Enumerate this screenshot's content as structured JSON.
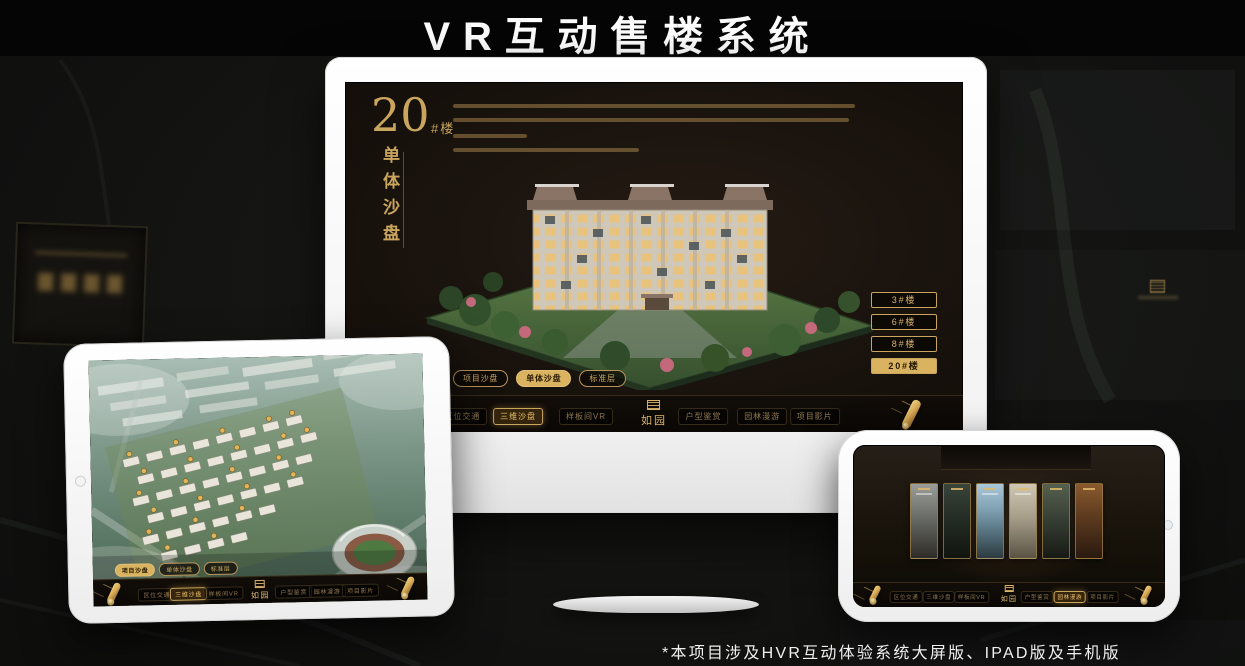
{
  "header": {
    "title": "VR互动售楼系统"
  },
  "footer": {
    "note": "*本项目涉及HVR互动体验系统大屏版、IPAD版及手机版"
  },
  "colors": {
    "gold": "#c9a55e",
    "gold_active_bg": "#d9b360",
    "screen_bg": "#17110c",
    "frame_white": "#f5f5f5"
  },
  "app": {
    "logo_text": "如园",
    "sub_tabs": [
      "项目沙盘",
      "单体沙盘",
      "标准层"
    ],
    "nav": [
      "区位交通",
      "三维沙盘",
      "样板间VR",
      "户型鉴赏",
      "园林漫游",
      "项目影片"
    ]
  },
  "monitor": {
    "headline_no": "20",
    "headline_unit": "#楼",
    "headline_vertical": "单体沙盘",
    "floor_buttons": [
      "3#楼",
      "6#楼",
      "8#楼",
      "20#楼"
    ],
    "active_floor": "20#楼",
    "active_sub_tab": "单体沙盘",
    "active_nav": "三维沙盘"
  },
  "tablet": {
    "active_sub_tab": "项目沙盘",
    "active_nav": "三维沙盘"
  },
  "phone": {
    "active_nav": "园林漫游",
    "gallery_panels": 6
  }
}
